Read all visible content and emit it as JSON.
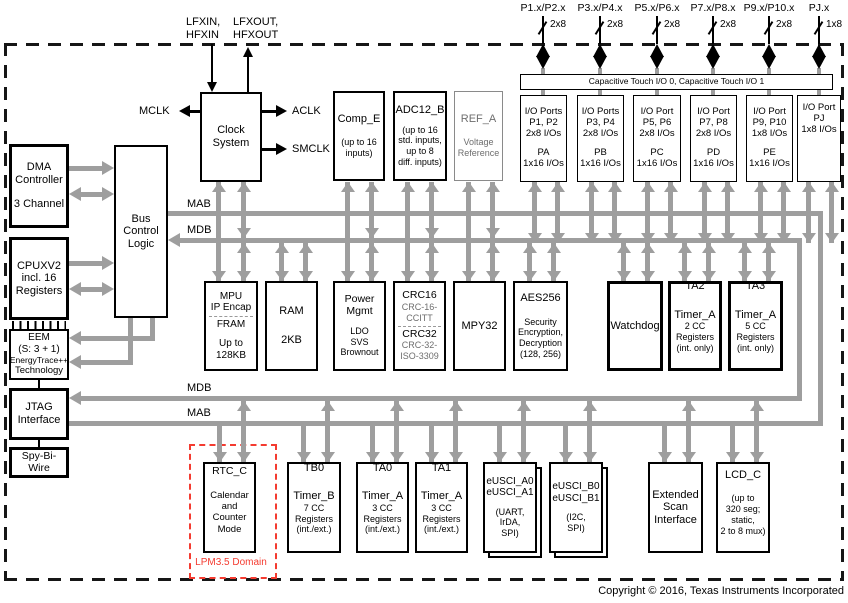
{
  "ports": {
    "labels": [
      "P1.x/P2.x",
      "P3.x/P4.x",
      "P5.x/P6.x",
      "P7.x/P8.x",
      "P9.x/P10.x",
      "PJ.x"
    ],
    "widths": [
      "2x8",
      "2x8",
      "2x8",
      "2x8",
      "2x8",
      "1x8"
    ]
  },
  "cap_touch_label": "Capacitive Touch I/O 0, Capacitive Touch I/O 1",
  "clock": {
    "l1": "Clock",
    "l2": "System",
    "in1": "LFXIN,",
    "in2": "HFXIN",
    "out1": "LFXOUT,",
    "out2": "HFXOUT",
    "mclk": "MCLK",
    "aclk": "ACLK",
    "smclk": "SMCLK"
  },
  "bus": {
    "mab": "MAB",
    "mdb": "MDB"
  },
  "io_ports": [
    {
      "l1": "I/O Ports",
      "l2": "P1, P2",
      "l3": "2x8 I/Os",
      "l4": "PA",
      "l5": "1x16 I/Os"
    },
    {
      "l1": "I/O Ports",
      "l2": "P3, P4",
      "l3": "2x8 I/Os",
      "l4": "PB",
      "l5": "1x16 I/Os"
    },
    {
      "l1": "I/O Port",
      "l2": "P5, P6",
      "l3": "2x8 I/Os",
      "l4": "PC",
      "l5": "1x16 I/Os"
    },
    {
      "l1": "I/O Port",
      "l2": "P7, P8",
      "l3": "2x8 I/Os",
      "l4": "PD",
      "l5": "1x16 I/Os"
    },
    {
      "l1": "I/O Port",
      "l2": "P9, P10",
      "l3": "1x8 I/Os",
      "l4": "PE",
      "l5": "1x16 I/Os"
    },
    {
      "l1": "I/O Port",
      "l2": "PJ",
      "l3": "1x8 I/Os",
      "l4": "",
      "l5": ""
    }
  ],
  "left": {
    "dma": {
      "l1": "DMA",
      "l2": "Controller",
      "l3": "3 Channel"
    },
    "bus_ctrl": {
      "l1": "Bus",
      "l2": "Control",
      "l3": "Logic"
    },
    "cpu": {
      "l1": "CPUXV2",
      "l2": "incl. 16",
      "l3": "Registers"
    },
    "eem": {
      "l1": "EEM",
      "l2": "(S: 3 + 1)",
      "l3": "EnergyTrace++",
      "l4": "Technology"
    },
    "jtag": {
      "l1": "JTAG",
      "l2": "Interface"
    },
    "sbw": {
      "l1": "Spy-Bi-",
      "l2": "Wire"
    }
  },
  "mid": {
    "comp": {
      "t": "Comp_E",
      "s1": "(up to 16",
      "s2": "inputs)"
    },
    "adc": {
      "t": "ADC12_B",
      "s1": "(up to 16",
      "s2": "std. inputs,",
      "s3": "up to 8",
      "s4": "diff. inputs)"
    },
    "ref": {
      "t": "REF_A",
      "s1": "Voltage",
      "s2": "Reference"
    },
    "mpu": {
      "t1": "MPU",
      "t2": "IP Encap",
      "t3": "FRAM",
      "s1": "Up to",
      "s2": "128KB"
    },
    "ram": {
      "t": "RAM",
      "s": "2KB"
    },
    "pmm": {
      "t1": "Power",
      "t2": "Mgmt",
      "s1": "LDO",
      "s2": "SVS",
      "s3": "Brownout"
    },
    "crc": {
      "t1": "CRC16",
      "s1": "CRC-16-",
      "s2": "CCITT",
      "t2": "CRC32",
      "s3": "CRC-32-",
      "s4": "ISO-3309"
    },
    "mpy": {
      "t": "MPY32"
    },
    "aes": {
      "t": "AES256",
      "s1": "Security",
      "s2": "Encryption,",
      "s3": "Decryption",
      "s4": "(128, 256)"
    },
    "wdt": {
      "t": "Watchdog"
    },
    "ta2": {
      "t": "TA2",
      "s1": "Timer_A",
      "s2": "2 CC",
      "s3": "Registers",
      "s4": "(int. only)"
    },
    "ta3": {
      "t": "TA3",
      "s1": "Timer_A",
      "s2": "5 CC",
      "s3": "Registers",
      "s4": "(int. only)"
    }
  },
  "bot": {
    "rtc": {
      "t": "RTC_C",
      "s1": "Calendar",
      "s2": "and",
      "s3": "Counter",
      "s4": "Mode"
    },
    "tb0": {
      "t": "TB0",
      "s1": "Timer_B",
      "s2": "7 CC",
      "s3": "Registers",
      "s4": "(int./ext.)"
    },
    "ta0": {
      "t": "TA0",
      "s1": "Timer_A",
      "s2": "3 CC",
      "s3": "Registers",
      "s4": "(int./ext.)"
    },
    "ta1": {
      "t": "TA1",
      "s1": "Timer_A",
      "s2": "3 CC",
      "s3": "Registers",
      "s4": "(int./ext.)"
    },
    "eusci_a": {
      "t1": "eUSCI_A0",
      "t2": "eUSCI_A1",
      "s1": "(UART,",
      "s2": "IrDA,",
      "s3": "SPI)"
    },
    "eusci_b": {
      "t1": "eUSCI_B0",
      "t2": "eUSCI_B1",
      "s1": "(I2C,",
      "s2": "SPI)"
    },
    "esi": {
      "l1": "Extended",
      "l2": "Scan",
      "l3": "Interface"
    },
    "lcd": {
      "t": "LCD_C",
      "s1": "(up to",
      "s2": "320 seg;",
      "s3": "static,",
      "s4": "2 to 8 mux)"
    }
  },
  "lpm_label": "LPM3.5 Domain",
  "copyright": "Copyright © 2016, Texas Instruments Incorporated",
  "colors": {
    "bus_gray": "#9e9e9e",
    "red": "#f43b30"
  }
}
